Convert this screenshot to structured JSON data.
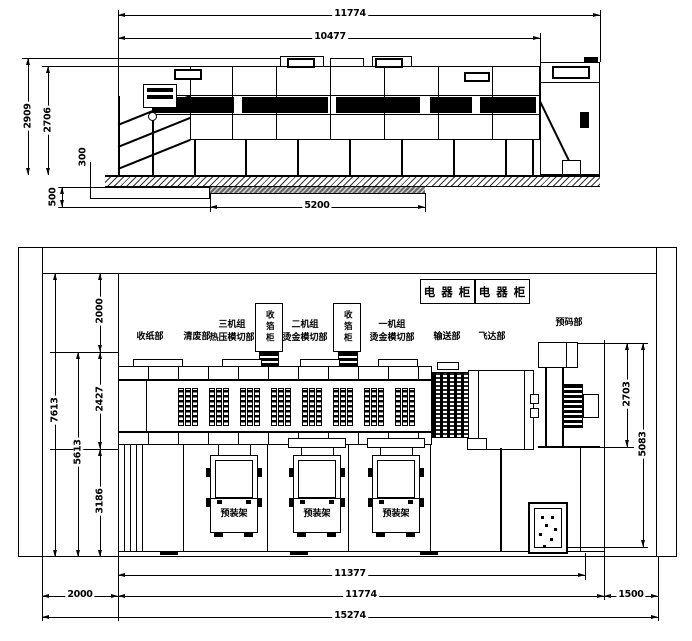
{
  "elevation": {
    "dims": {
      "total_length": "11774",
      "body_length": "10477",
      "overall_height": "2909",
      "body_height": "2706",
      "floor_step": "300",
      "pit_depth": "500",
      "pit_length": "5200"
    }
  },
  "plan": {
    "cabinets": {
      "left": "电 器 柜",
      "right": "电 器 柜"
    },
    "sections": {
      "paper_delivery": "收纸部",
      "waste_stripping": "清废部",
      "unit3_name": "三机组",
      "unit3_type": "热压模切部",
      "foil_cabinet_a": "收箔柜",
      "unit2_name": "二机组",
      "unit2_type": "烫金模切部",
      "foil_cabinet_b": "收箔柜",
      "unit1_name": "一机组",
      "unit1_type": "烫金模切部",
      "conveyor": "输送部",
      "feeder": "飞达部",
      "prestacker": "预码部"
    },
    "racks": {
      "a": "预装架",
      "b": "预装架",
      "c": "预装架"
    },
    "dims": {
      "top_clearance": "2000",
      "machine_depth": "2427",
      "rack_depth": "3186",
      "machine_rack_depth": "5613",
      "total_depth": "7613",
      "prestacker_depth": "2703",
      "right_depth": "5083",
      "inner_length": "11377",
      "left_clearance": "2000",
      "machine_length": "11774",
      "right_clearance": "1500",
      "total_length": "15274"
    }
  }
}
